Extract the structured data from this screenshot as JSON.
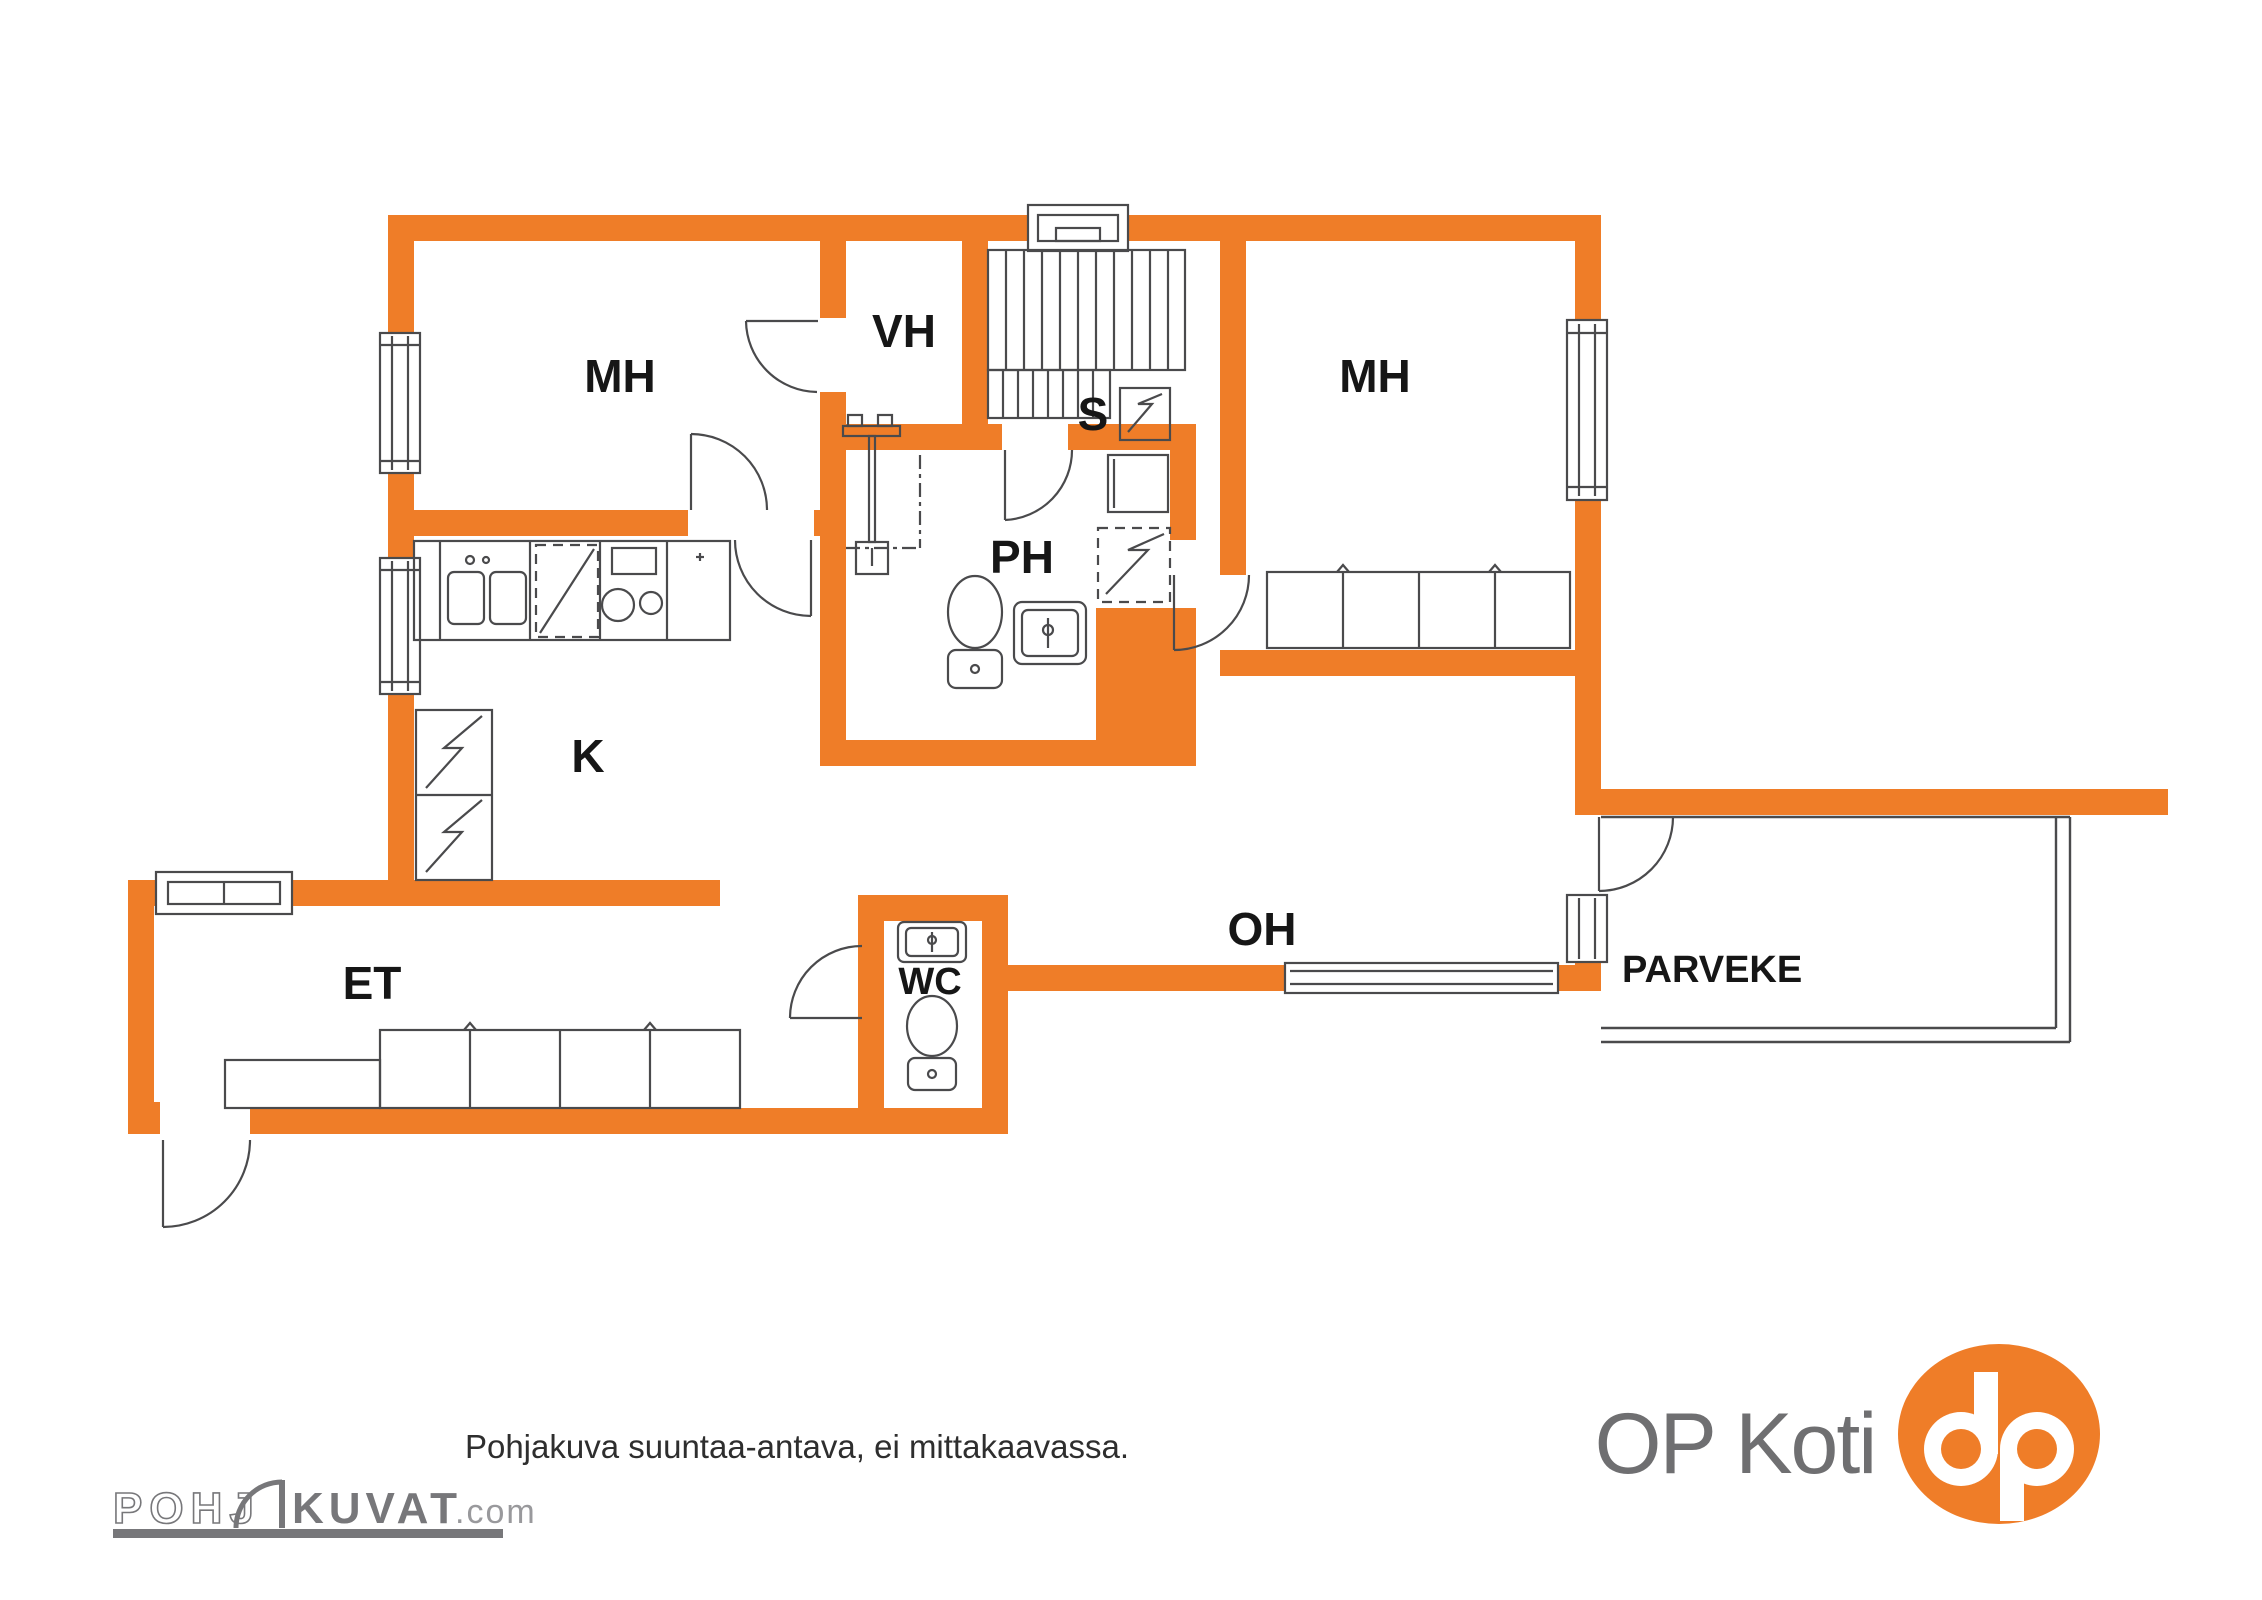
{
  "document_type": "apartment floor plan",
  "colors": {
    "wall_orange": "#EF7D28",
    "line_gray": "#4A4A4C",
    "label_black": "#161616",
    "logo_gray": "#77777A",
    "op_text_gray": "#6F6F71",
    "dotcom_gray": "#99999C",
    "footer_text": "#2E2E2E",
    "background": "#FFFFFF"
  },
  "rooms": {
    "mh_left": "MH",
    "vh": "VH",
    "sauna": "S",
    "mh_right": "MH",
    "ph": "PH",
    "kitchen": "K",
    "et": "ET",
    "wc": "WC",
    "oh": "OH",
    "parveke": "PARVEKE"
  },
  "footer": {
    "disclaimer": "Pohjakuva suuntaa-antava, ei mittakaavassa."
  },
  "branding": {
    "pohjakuvat_outline": "POHJ",
    "pohjakuvat_solid": "KUVAT",
    "pohjakuvat_suffix": ".com",
    "op_koti": "OP Koti"
  }
}
